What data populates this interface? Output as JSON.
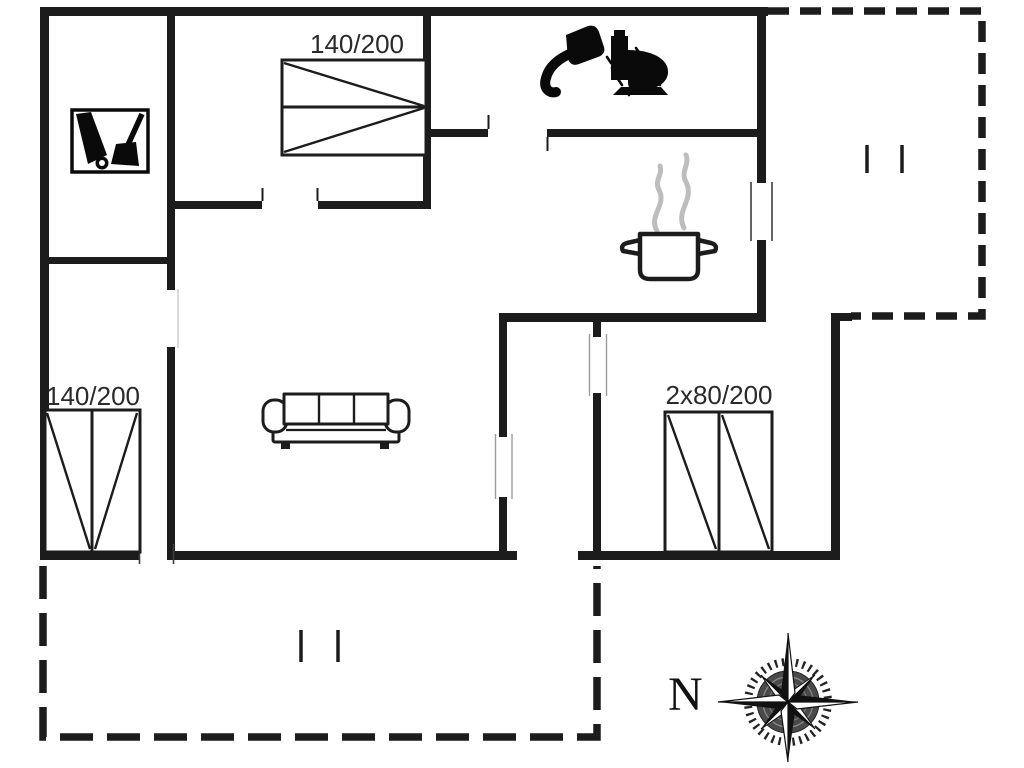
{
  "page": {
    "background": "#ffffff",
    "type": "holiday-house-floor-plan"
  },
  "plan": {
    "colors": {
      "wall": "#1c1c1c",
      "furniture_line": "#1c1c1c",
      "steam": "#bdbdbd",
      "compass_inner": "#4a4a4a"
    },
    "labels": {
      "bed_top": "140/200",
      "bed_bottom_left": "140/200",
      "bed_bottom_right": "2x80/200",
      "compass_north": "N"
    },
    "icons": [
      {
        "name": "cleaning-equipment-icon",
        "meaning": "cleaning equipment / utility"
      },
      {
        "name": "shower-icon",
        "meaning": "shower"
      },
      {
        "name": "toilet-icon",
        "meaning": "toilet"
      },
      {
        "name": "cooking-pot-icon",
        "meaning": "kitchen"
      },
      {
        "name": "sofa-icon",
        "meaning": "living room sofa"
      },
      {
        "name": "double-bed-top-icon",
        "meaning": "bed 140/200"
      },
      {
        "name": "double-bed-bottom-left-icon",
        "meaning": "bed 140/200"
      },
      {
        "name": "double-bed-bottom-right-icon",
        "meaning": "bed 2x80/200"
      },
      {
        "name": "compass-rose-icon",
        "meaning": "north direction"
      },
      {
        "name": "terrace-dashed-outline",
        "meaning": "terrace (dashed)"
      }
    ]
  }
}
